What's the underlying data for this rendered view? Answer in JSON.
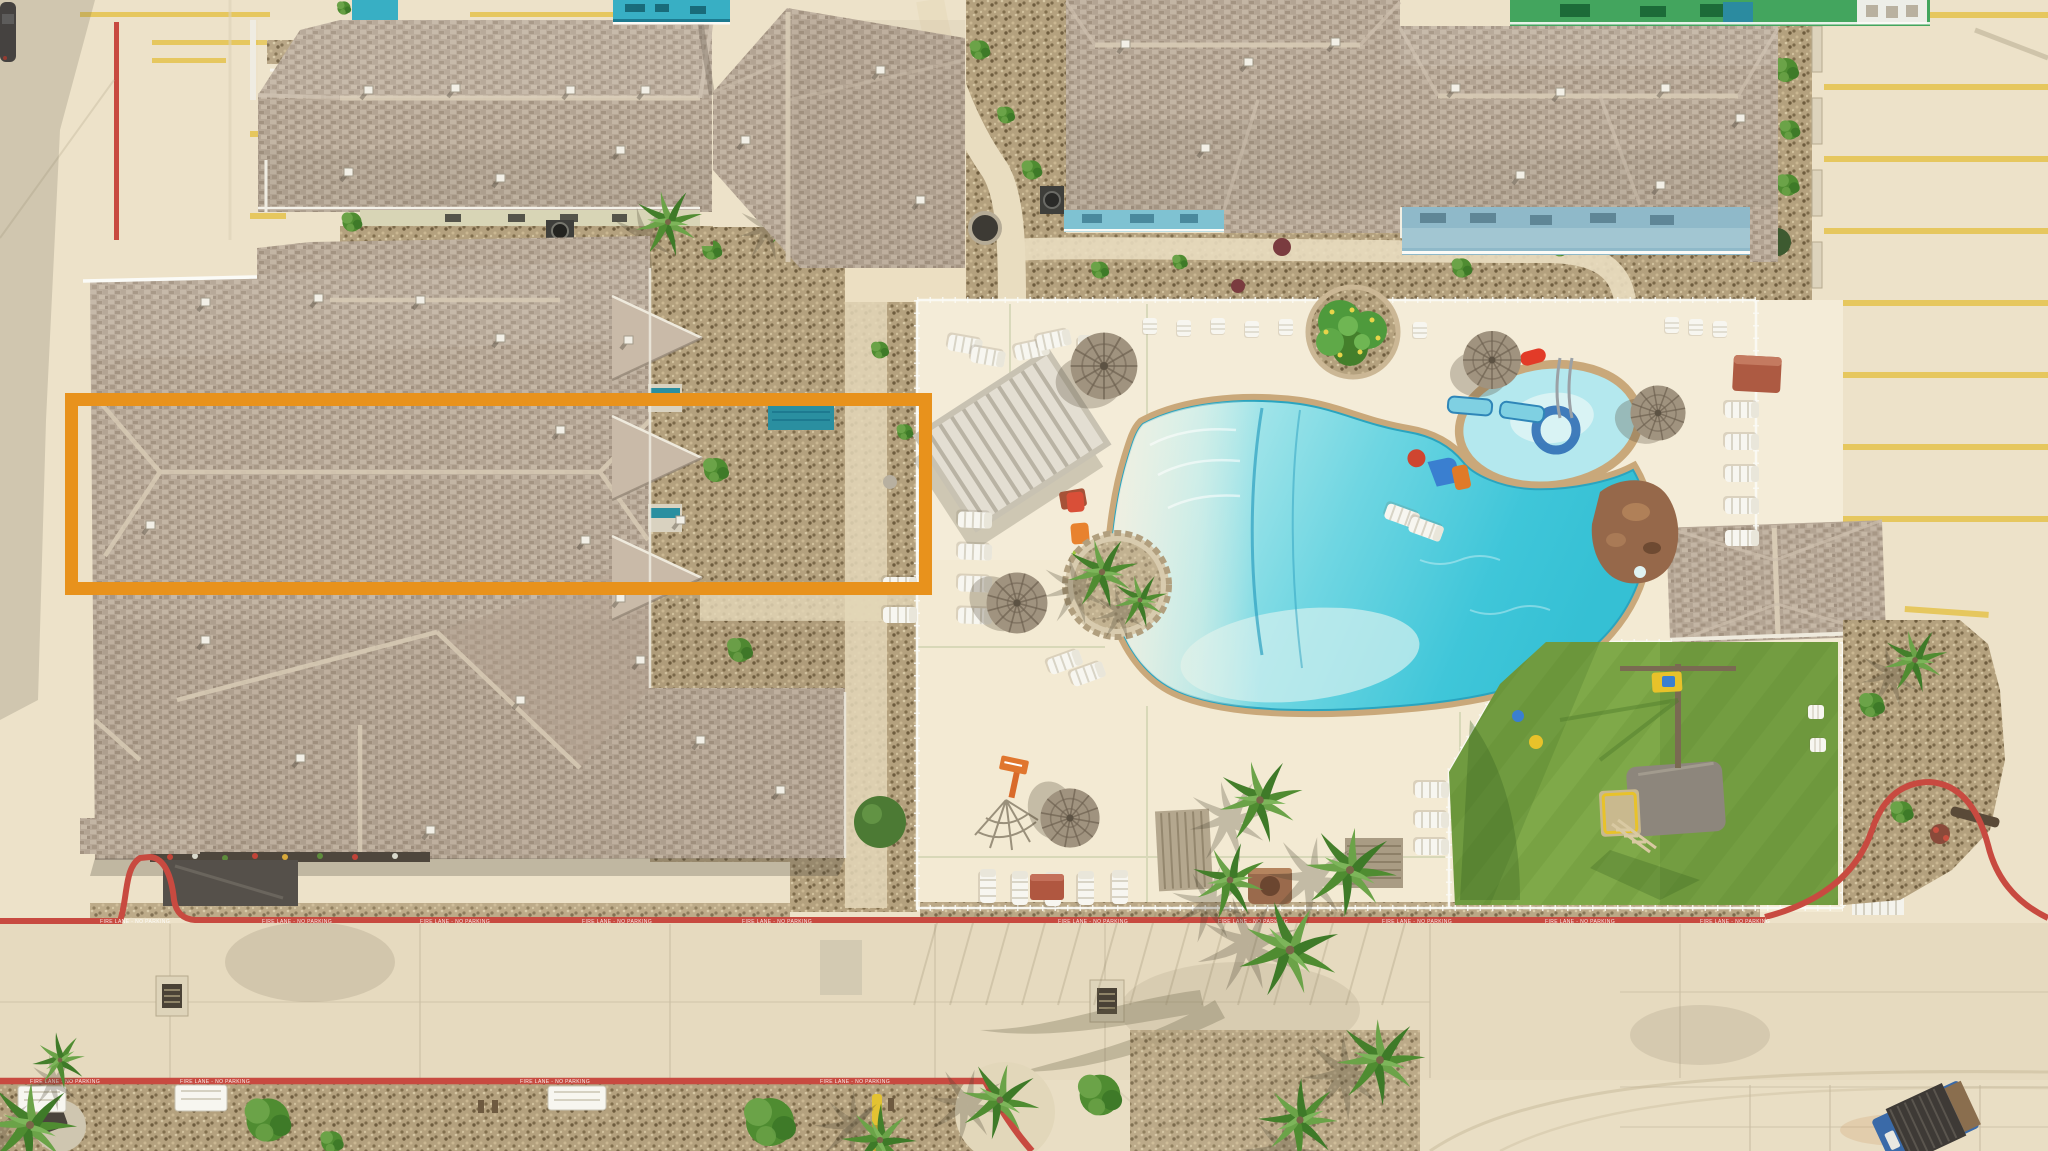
{
  "scene": {
    "description": "Aerial drone photo of a condo resort: shingle-roof buildings, lagoon-style pool with thatch umbrellas, turf playground, parking lots and fire-lane curbs",
    "annotation": {
      "x": 65,
      "y": 393,
      "width": 867,
      "height": 202,
      "stroke_width": 13,
      "color": "#E8921C"
    },
    "curb": {
      "stencil_text": "FIRE LANE - NO PARKING",
      "color": "#C84A40"
    },
    "palette": {
      "concrete": "#EDE2C9",
      "deck": "#F3EAD3",
      "road": "#E6DABF",
      "roof": "#B7A897",
      "roof_light": "#C9BBAA",
      "roof_dark": "#9E8E7D",
      "ridge": "#D8CBB5",
      "gravel": "#B4A17E",
      "gravel_dark": "#8A774F",
      "turf": "#78A243",
      "turf_light": "#85AF4F",
      "turf_shadow": "#4F7B2B",
      "water_shallow": "#C8EEF0",
      "water_mid": "#7FDCE6",
      "water_deep": "#3CC4D8",
      "coping": "#C9A87A",
      "fence": "#FAFAF4",
      "umbrella": "#A0937F",
      "umbrella_dark": "#6D6150",
      "white_furniture": "#F7F6F0",
      "red_curb": "#C84A40",
      "yellow_line": "#E6C75E",
      "palm": "#4F8C31",
      "palm_light": "#6BA348",
      "teal_deck": "#38AFC4",
      "green_wall": "#43A55E",
      "blue_band": "#8FB9C9",
      "rock": "#96684A",
      "shade_canopy": "#8D867C",
      "chair_orange": "#E8822E",
      "chair_green": "#A3C93E",
      "chair_teal": "#3CBCB4",
      "chair_red": "#D94F38",
      "slide_blue": "#3A7FD0",
      "truck": "#3A6AA8"
    }
  }
}
